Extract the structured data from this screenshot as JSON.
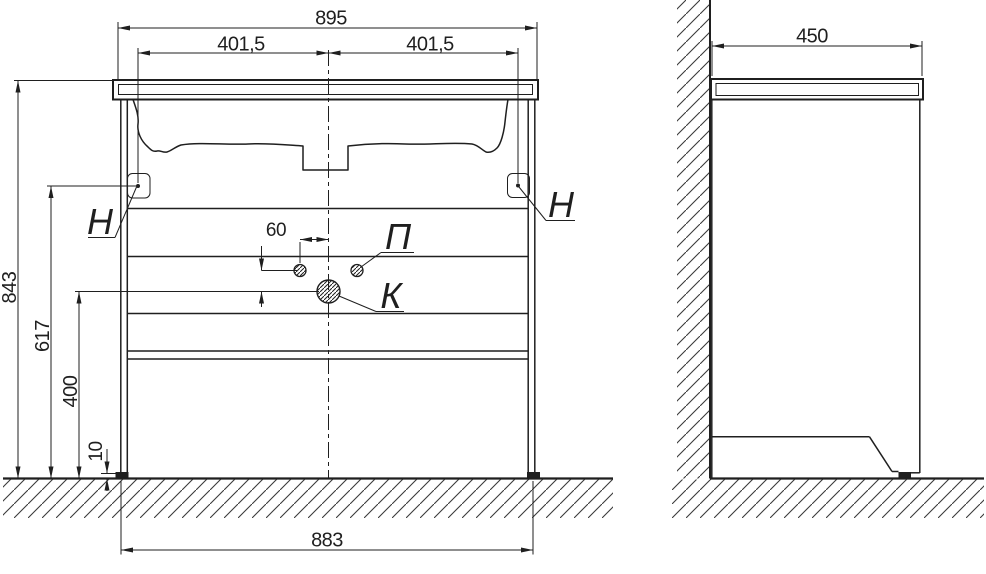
{
  "drawing": {
    "type": "furniture technical drawing, bathroom vanity with washbasin, front and side views",
    "front_view": {
      "dims": {
        "overall_width": "895",
        "left_hinge_offset": "401,5",
        "right_hinge_offset": "401,5",
        "overall_height": "843",
        "hinge_height": "617",
        "drain_hole_height": "400",
        "foot_height": "10",
        "cabinet_width": "883",
        "handle_hole_offset": "60",
        "hole_vertical_gap": "40"
      },
      "labels": {
        "hinge_left": "Н",
        "hinge_right": "Н",
        "handle_holes": "П",
        "drain_hole": "К"
      }
    },
    "side_view": {
      "dims": {
        "depth": "450"
      }
    },
    "colors": {
      "line": "#1f1f1f",
      "background": "#ffffff",
      "hatch": "#3a3a3a"
    }
  }
}
